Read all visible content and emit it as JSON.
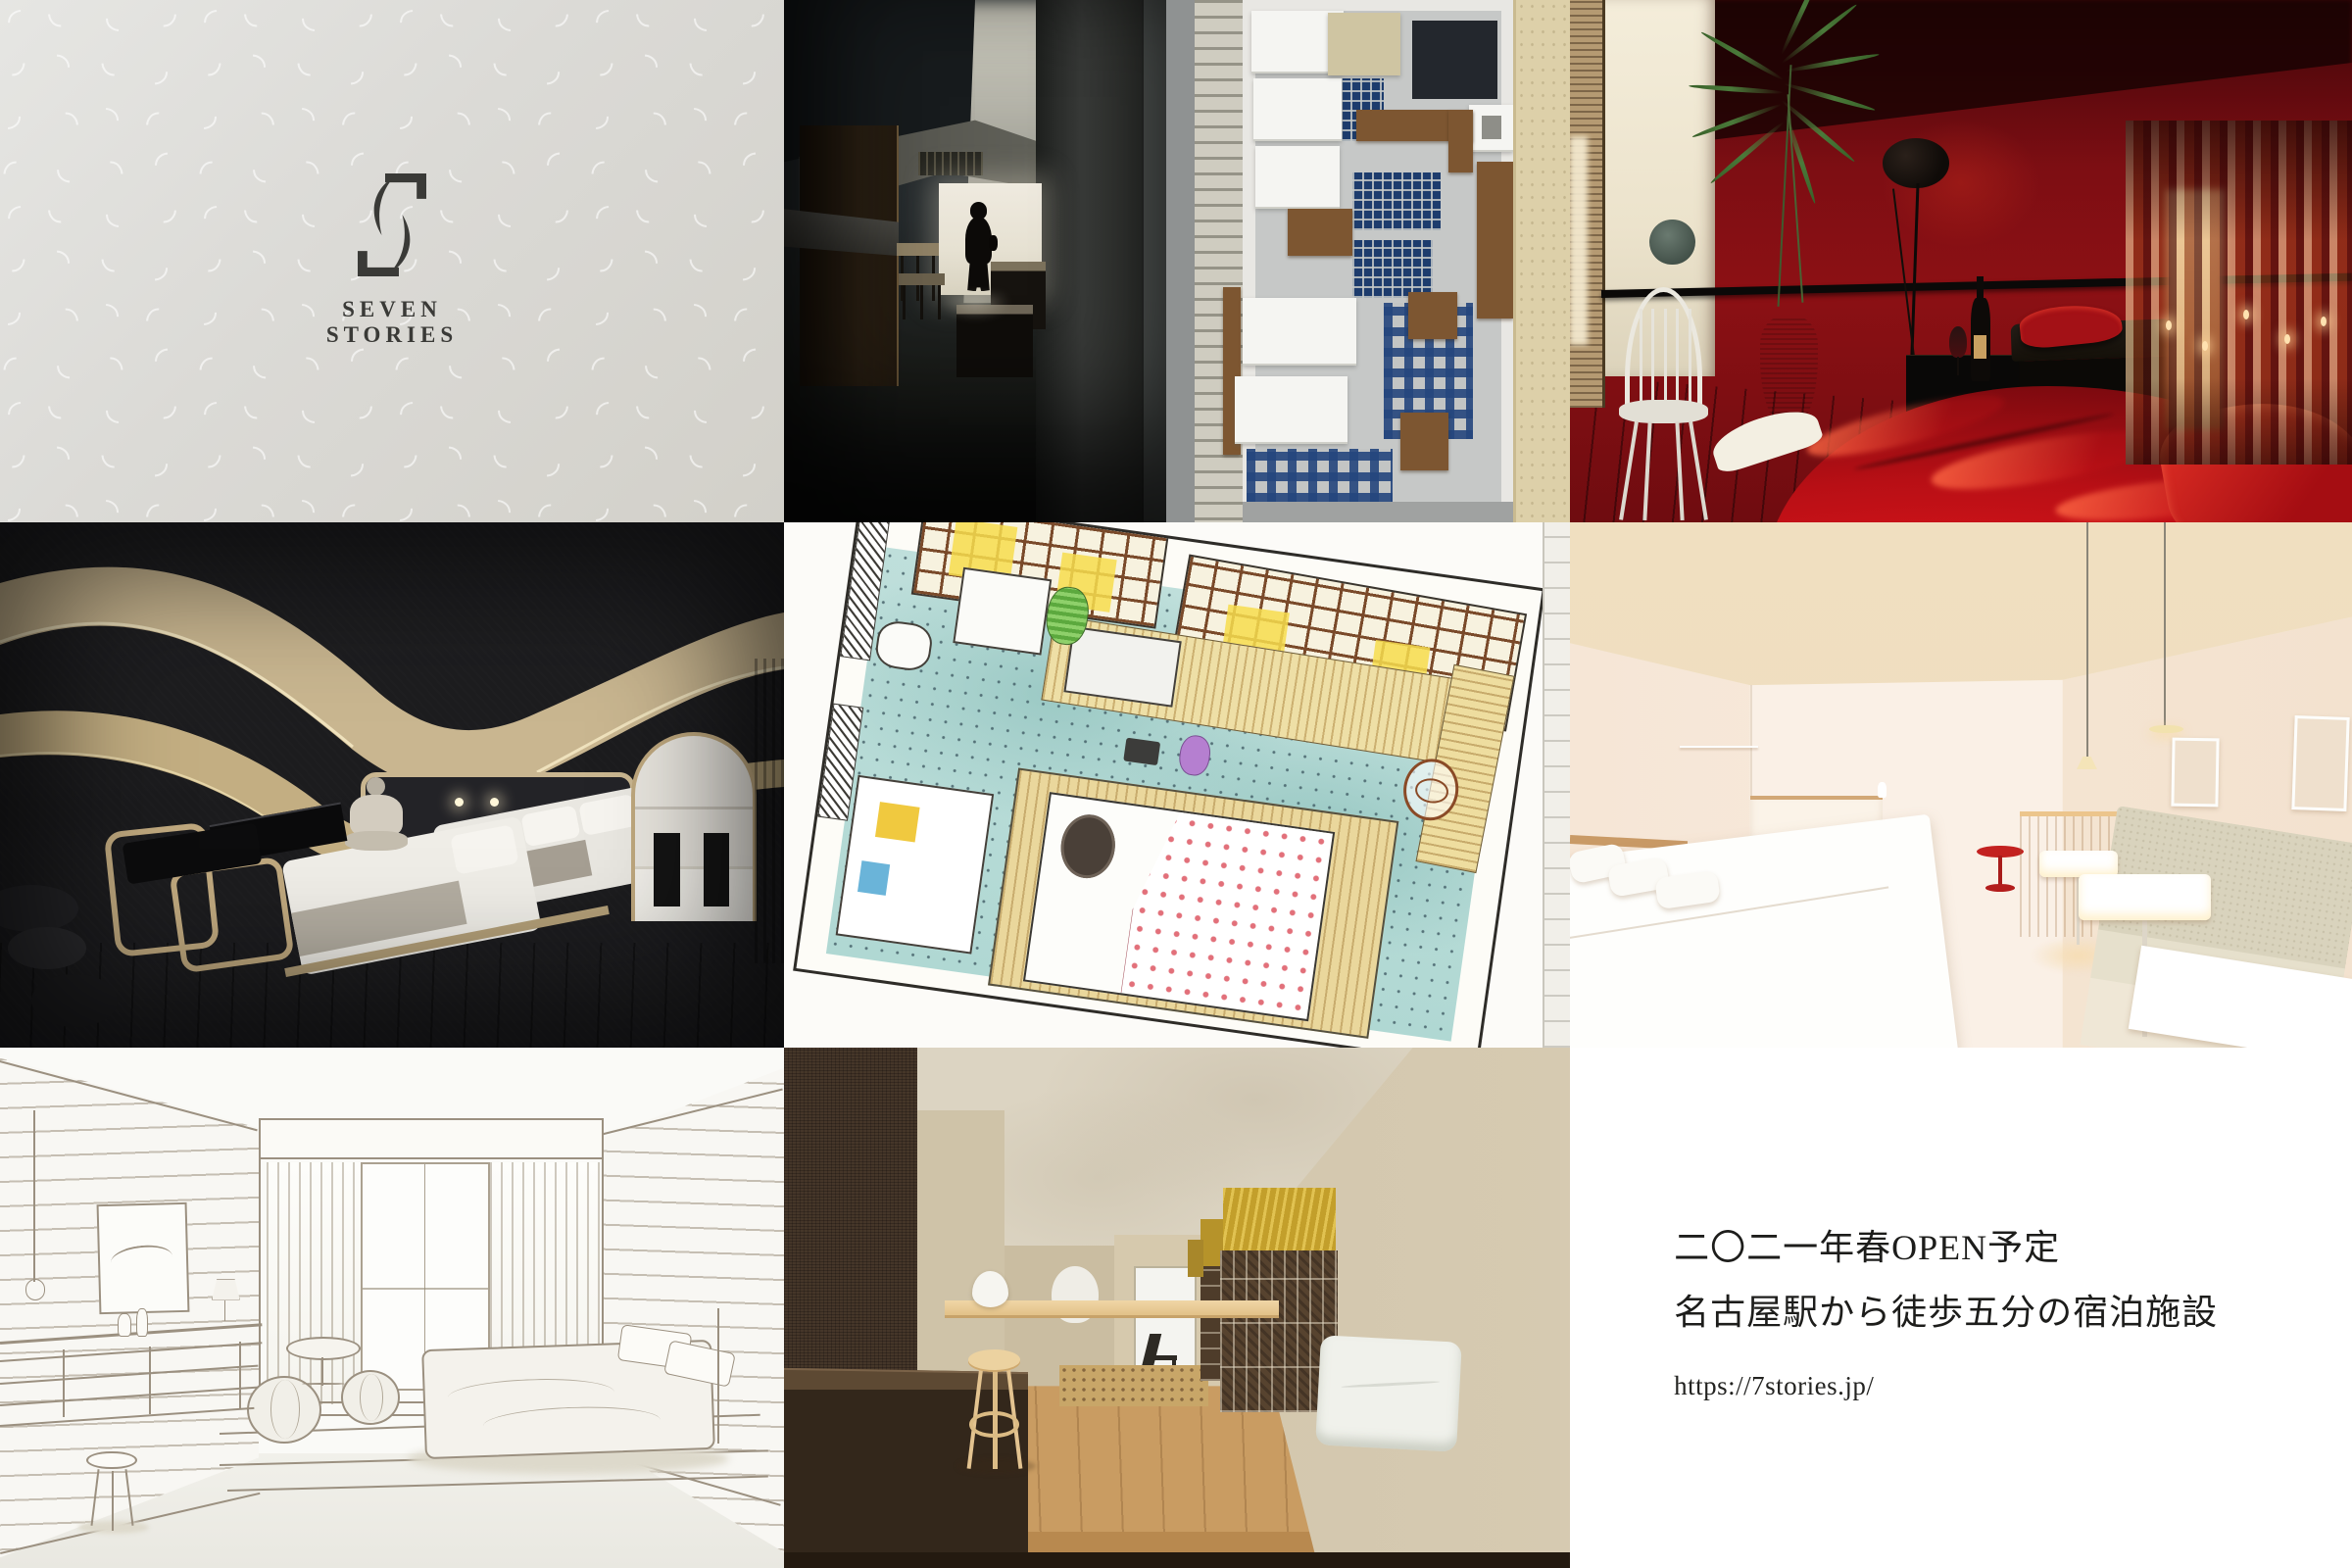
{
  "brand": {
    "logo_text_line1": "SEVEN",
    "logo_text_line2": "STORIES",
    "pattern_glyphs": [
      "◜",
      "◞",
      "◝",
      "◟"
    ]
  },
  "announcement": {
    "line1": "二〇二一年春OPEN予定",
    "line2": "名古屋駅から徒歩五分の宿泊施設",
    "url": "https://7stories.jp/"
  },
  "palette": {
    "logo_ink": "#3a3a37",
    "logo_bg_a": "#e6e6e3",
    "logo_bg_b": "#d2d0c9",
    "pattern_white": "rgba(255,255,255,0.6)",
    "photo_base": "#262e31",
    "doorway": "#eae6da",
    "model_gray": "#c6c8c7",
    "model_wall": "#e8e7e3",
    "mosaic_blue": "#1d3c6d",
    "model_wood": "#7d5631",
    "concrete": "#ddd0a9",
    "red_wall": "#8c1014",
    "red_bed": "#b80f15",
    "cream": "#f0e9d7",
    "terracotta": "#c9712f",
    "leaf": "#4a7a3a",
    "dark_room": "#1c1c1e",
    "ribbon": "#c9b690",
    "linen": "#e9e7e1",
    "plan_line": "#2e2c28",
    "plan_teal": "#b8dcd8",
    "plan_grid": "#7a4a2a",
    "plan_yellow": "#f7dd4e",
    "pink_wall": "#f8ece0",
    "pink_ceiling": "#eeddc0",
    "pink_floor": "#f5ecdc",
    "pink_wood": "#c99a66",
    "pink_red": "#c32120",
    "pink_bench": "#d9d3bd",
    "sketch_line": "#8d8173",
    "render_wall": "#d6cab1",
    "render_dark_wall": "#453629",
    "render_counter": "#33271b",
    "render_floor": "#c99c62",
    "render_tile": "#57432f",
    "gold": "#c39f2b",
    "stool_wood": "#ecd2a0",
    "announce_bg": "#ffffff",
    "ink": "#1d1d1b"
  }
}
